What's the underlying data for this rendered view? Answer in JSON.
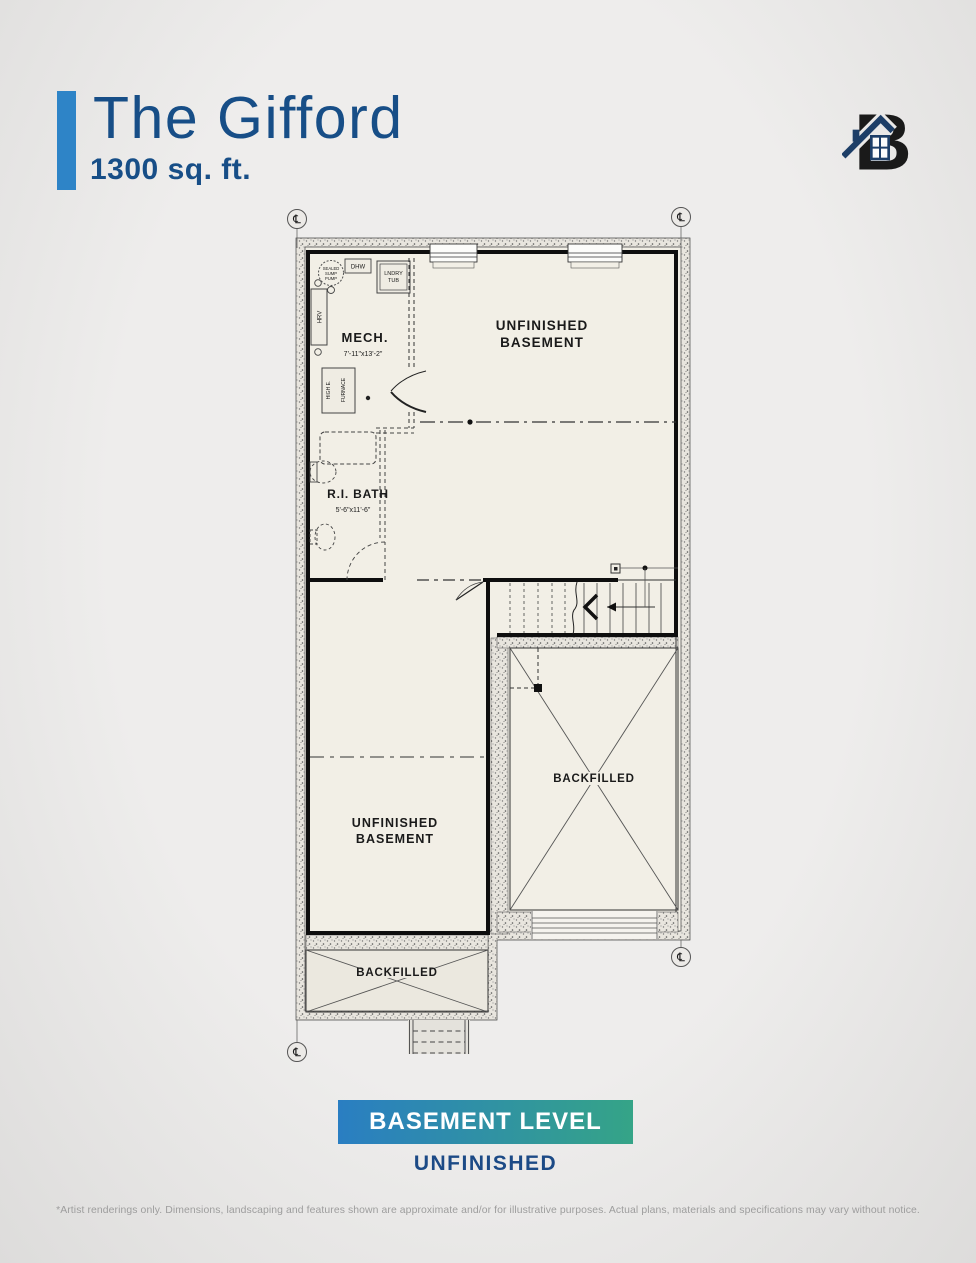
{
  "header": {
    "title": "The Gifford",
    "subtitle": "1300 sq. ft."
  },
  "logo": {
    "letter": "B"
  },
  "plan": {
    "rooms": {
      "mech_label": "MECH.",
      "mech_dims": "7'-11\"x13'-2\"",
      "bath_label": "R.I. BATH",
      "bath_dims": "5'-6\"x11'-6\"",
      "unfinished_line1": "UNFINISHED",
      "unfinished_line2": "BASEMENT",
      "backfilled_label": "BACKFILLED"
    },
    "fixtures": {
      "dhw": "DHW",
      "lndry_line1": "LNDRY",
      "lndry_line2": "TUB",
      "hrv": "HRV",
      "furnace_line1": "HIGH E.",
      "furnace_line2": "FURNACE",
      "sump_line1": "SEALED",
      "sump_line2": "SUMP",
      "sump_line3": "PUMP"
    },
    "symbols": {
      "centerline": "℄"
    }
  },
  "footer": {
    "level_banner": "BASEMENT LEVEL",
    "level_status": "UNFINISHED",
    "disclaimer": "*Artist renderings only. Dimensions, landscaping and features shown are approximate and/or for illustrative purposes. Actual plans, materials and specifications may vary without notice."
  },
  "colors": {
    "accent_blue": "#2e84c7",
    "title_navy": "#174e87",
    "logo_navy": "#1d3e67",
    "banner_gradient_start": "#2a7ec2",
    "banner_gradient_end": "#35a487",
    "status_navy": "#1c4a86",
    "floor_cream": "#f2efe6"
  }
}
